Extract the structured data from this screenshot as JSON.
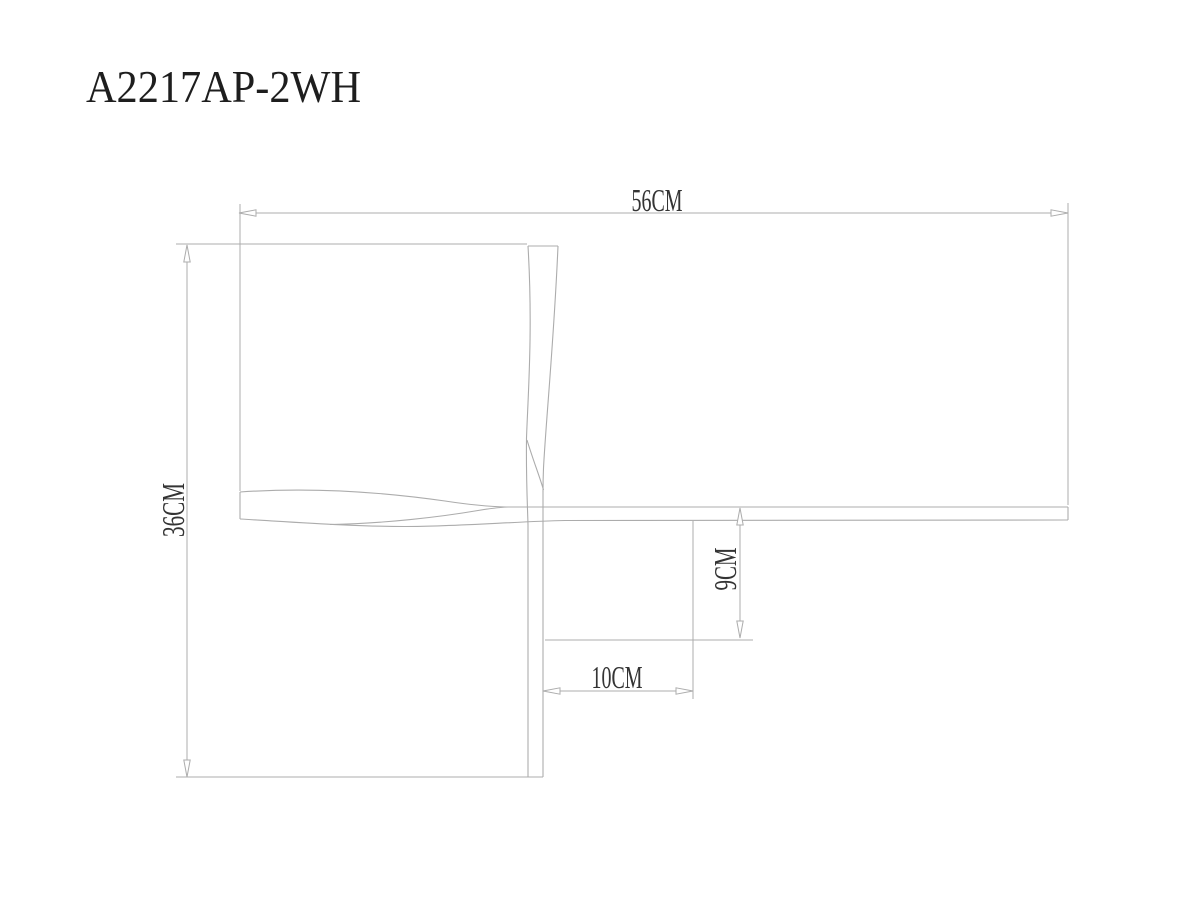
{
  "title": "A2217AP-2WH",
  "colors": {
    "background": "#ffffff",
    "line": "#acacac",
    "dimension_text": "#343434",
    "title_text": "#1e1e1e"
  },
  "drawing": {
    "type": "technical-dimension-drawing",
    "dimensions": {
      "overall_width": "56CM",
      "overall_height": "36CM",
      "vertical_offset": "9CM",
      "horizontal_offset": "10CM"
    }
  }
}
